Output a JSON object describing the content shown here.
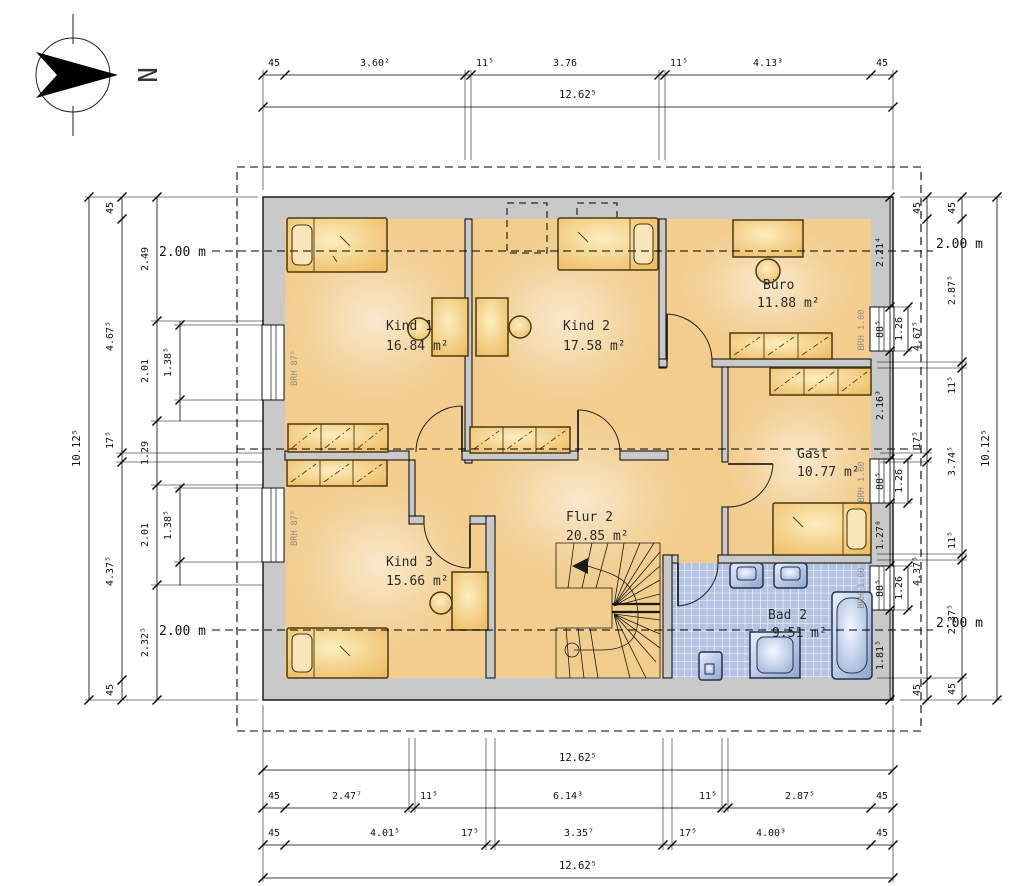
{
  "compass": {
    "label": "N"
  },
  "rooms": [
    {
      "id": "kind1",
      "name": "Kind 1",
      "area": "16.84 m²"
    },
    {
      "id": "kind2",
      "name": "Kind 2",
      "area": "17.58 m²"
    },
    {
      "id": "buero",
      "name": "Büro",
      "area": "11.88 m²"
    },
    {
      "id": "gast",
      "name": "Gast",
      "area": "10.77 m²"
    },
    {
      "id": "kind3",
      "name": "Kind 3",
      "area": "15.66 m²"
    },
    {
      "id": "flur2",
      "name": "Flur 2",
      "area": "20.85 m²"
    },
    {
      "id": "bad2",
      "name": "Bad 2",
      "area": "9.51 m²"
    }
  ],
  "window_sills": {
    "left": "BRH 87⁵",
    "right": "BRH 1.00"
  },
  "height_line_label": "2.00 m",
  "dims": {
    "top": {
      "chain": [
        "45",
        "3.60²",
        "11⁵",
        "3.76",
        "11⁵",
        "4.13³",
        "45"
      ],
      "total": "12.62⁵"
    },
    "bottom": {
      "total_upper": "12.62⁵",
      "chain1": [
        "45",
        "2.47⁷",
        "11⁵",
        "6.14³",
        "11⁵",
        "2.87⁵",
        "45"
      ],
      "chain2": [
        "45",
        "4.01⁵",
        "17⁵",
        "3.35⁷",
        "17⁵",
        "4.00³",
        "45"
      ],
      "total_lower": "12.62⁵"
    },
    "left": {
      "total": "10.12⁵",
      "outer": [
        "45",
        "4.67⁵",
        "17⁵",
        "4.37⁵",
        "45"
      ],
      "inner": [
        "2.49",
        "2.01",
        "1.29",
        "2.01",
        "2.32⁵"
      ],
      "windows": [
        "1.38⁵",
        "1.38⁵"
      ]
    },
    "right": {
      "total": "10.12⁵",
      "outer": [
        "45",
        "2.87⁵",
        "11⁵",
        "3.74⁵",
        "11⁵",
        "2.37⁵",
        "45"
      ],
      "mid": [
        "45",
        "4.67⁵",
        "17⁵",
        "4.37⁵",
        "45"
      ],
      "wall": [
        "2.21⁴",
        "88⁵",
        "2.16³",
        "88⁵",
        "1.27⁸",
        "88⁵",
        "1.81⁵"
      ],
      "window_widths": [
        "1.26",
        "1.26",
        "1.26"
      ]
    }
  }
}
